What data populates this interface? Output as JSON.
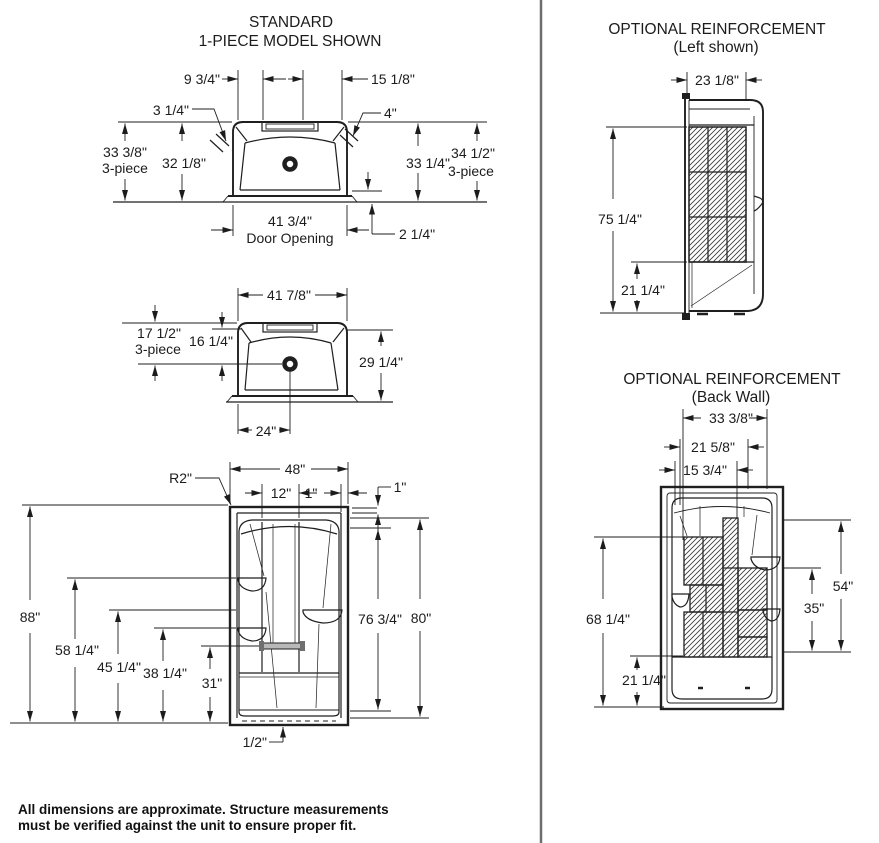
{
  "colors": {
    "ink": "#1c1c1c",
    "divider": "#6e6e6e",
    "grab_bar": "#b9b9b9",
    "hatch": "#3a3a3a"
  },
  "views": {
    "standard_plan": {
      "title_line1": "STANDARD",
      "title_line2": "1-PIECE MODEL SHOWN",
      "dim_top_left_offset": "9 3/4\"",
      "dim_top_right_offset": "15 1/8\"",
      "dim_ledge_left": "3 1/4\"",
      "dim_ledge_right": "4\"",
      "dim_depth_overall_3piece": "33 3/8\"",
      "label_3piece_left": "3-piece",
      "dim_depth_inner": "32 1/8\"",
      "dim_depth_right_inner": "33 1/4\"",
      "dim_depth_overall_right": "34 1/2\"",
      "label_3piece_right": "3-piece",
      "dim_door_opening": "41 3/4\"",
      "label_door_opening": "Door Opening",
      "dim_sill": "2 1/4\""
    },
    "three_piece_plan": {
      "dim_width_overall": "41 7/8\"",
      "dim_drain_from_front_3piece": "17 1/2\"",
      "label_3piece": "3-piece",
      "dim_drain_from_front_inner": "16 1/4\"",
      "dim_depth": "29 1/4\"",
      "dim_drain_from_left": "24\""
    },
    "front_elevation": {
      "dim_corner_radius": "R2\"",
      "dim_width_overall": "48\"",
      "dim_center_column": "12\"",
      "dim_wall_thickness": "1\"",
      "dim_top_flange": "1\"",
      "dim_height_overall": "88\"",
      "dim_shelf_upper": "58 1/4\"",
      "dim_shelf_right": "45 1/4\"",
      "dim_shelf_lower": "38 1/4\"",
      "dim_grab_bar": "31\"",
      "dim_opening_height": "76 3/4\"",
      "dim_unit_height": "80\"",
      "dim_base_gap": "1/2\""
    },
    "reinforcement_left": {
      "title_line1": "OPTIONAL REINFORCEMENT",
      "title_line2": "(Left shown)",
      "dim_width": "23 1/8\"",
      "dim_height": "75 1/4\"",
      "dim_base_height": "21 1/4\""
    },
    "reinforcement_back": {
      "title_line1": "OPTIONAL REINFORCEMENT",
      "title_line2": "(Back Wall)",
      "dim_width_1": "33 3/8\"",
      "dim_width_2": "21 5/8\"",
      "dim_width_3": "15 3/4\"",
      "dim_height": "68 1/4\"",
      "dim_base_height": "21 1/4\"",
      "dim_right_upper": "54\"",
      "dim_right_lower": "35\""
    }
  },
  "footnote": {
    "line1": "All dimensions are approximate. Structure measurements",
    "line2": "must be verified against the unit to ensure proper fit."
  }
}
